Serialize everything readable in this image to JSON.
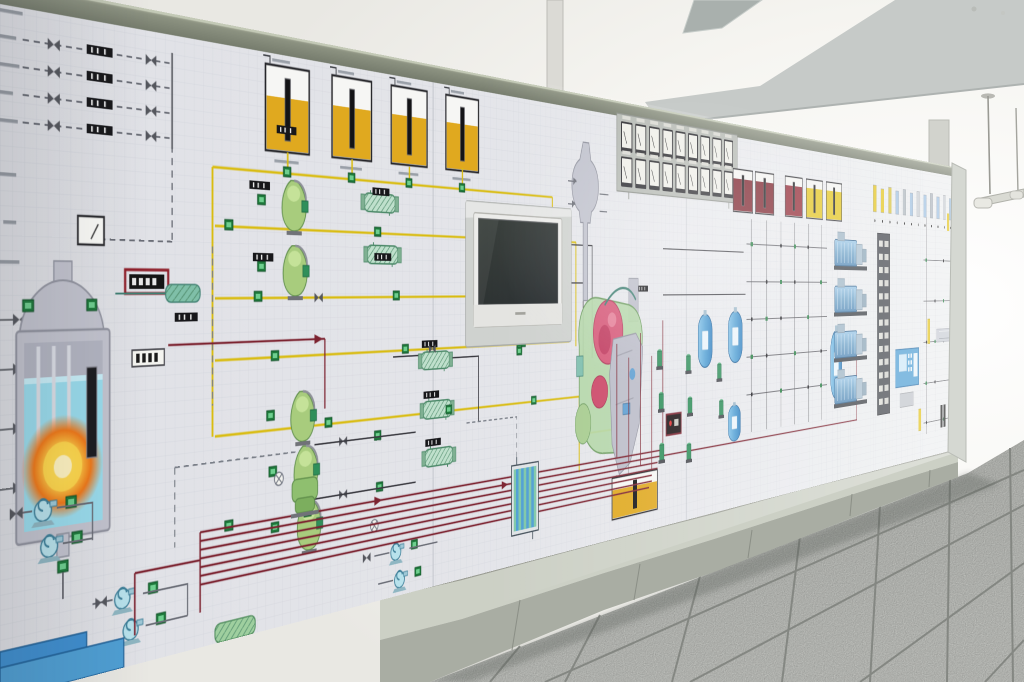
{
  "colors": {
    "ceiling": "#f2f0ec",
    "beam": "#c6cac8",
    "fan_blade": "#a9b0ad",
    "wall": "#f7f6f2",
    "floor_tile": "#d8dad5",
    "floor_grout": "#7e817c",
    "panel_face": "#e3e4e8",
    "panel_grid": "#c8cbd4",
    "panel_band": "#8b9180",
    "plinth_light": "#ccd0c5",
    "plinth_dark": "#a9ada3",
    "side_edge": "#d5d8d2",
    "pipe_red": "#7c2330",
    "pipe_yellow": "#d9bc10",
    "pipe_dark": "#3a3a40",
    "pipe_grey": "#8b8f96",
    "pipe_teal": "#3f7f72",
    "water_blue": "#9adced",
    "tank_yellow": "#e0a91f",
    "valve_green": "#1f7a3c",
    "vessel_grey": "#c3c4cf",
    "monitor_bezel": "#ececea",
    "monitor_screen": "#2e332f",
    "display_red": "#8f1f2a",
    "gauge_face": "#efefe8",
    "gauge_frame": "#26262a",
    "cabinet_blue": "#4f9fd4",
    "turbine_pink": "#d65878",
    "turbine_green": "#b2d6a6"
  },
  "panel": {
    "day_tanks": {
      "count": 4,
      "fill_level": 0.62
    },
    "service_tanks": {
      "count": 5,
      "colors": [
        "#7a1e28",
        "#7a1e28",
        "#8f2430",
        "#e3c41c",
        "#e3c41c"
      ]
    },
    "gauge_board": {
      "rows": 2,
      "columns": 9
    },
    "generators": {
      "count": 4
    },
    "indicator_bars": {
      "count": 12,
      "colors": [
        "#e3c41c",
        "#e3c41c",
        "#d8c23a",
        "#9fc0e0",
        "#aeb6be",
        "#9fc0e0",
        "#c8ccd2",
        "#9fc0e0",
        "#aeb6be",
        "#9fc0e0",
        "#c8ccd2",
        "#9fc0e0"
      ]
    },
    "terminal_strip_rows": 13
  }
}
